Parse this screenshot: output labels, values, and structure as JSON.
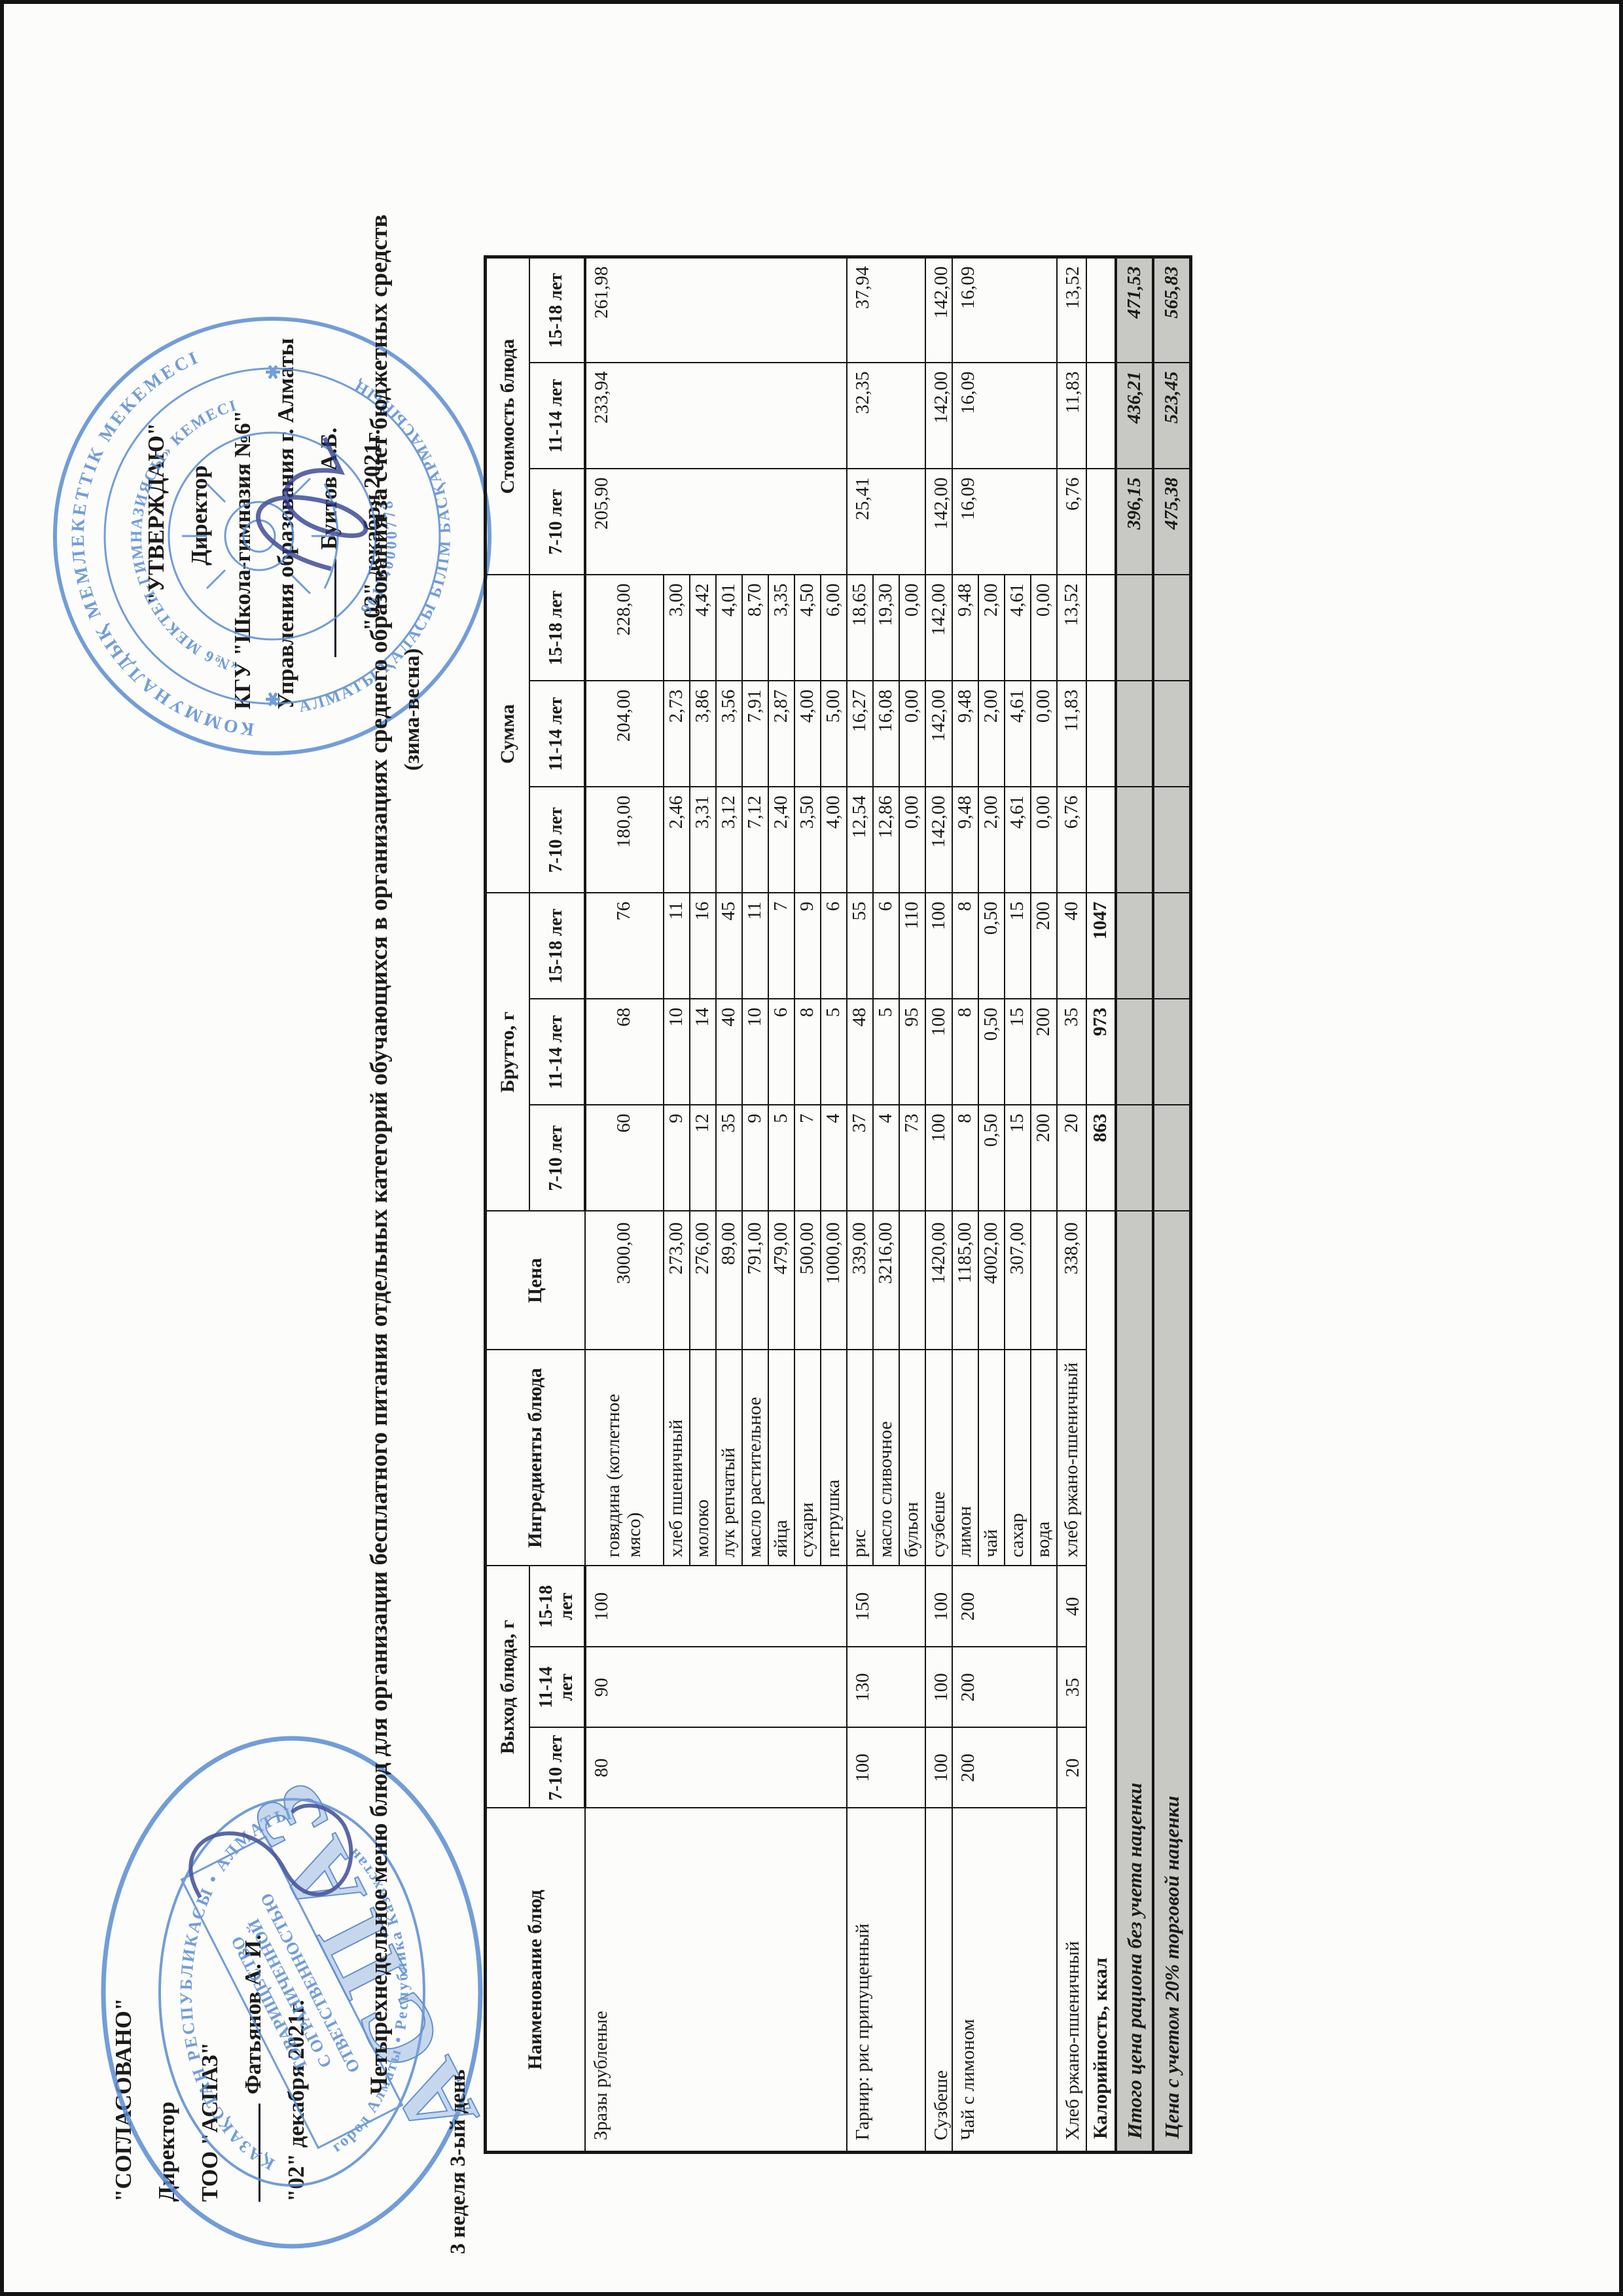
{
  "agreed_block": {
    "title": "\"СОГЛАСОВАНО\"",
    "role": "Директор",
    "org_line1": "ТОО \"АСПАЗ\"",
    "signer": "Фатьянов А. И.",
    "date": "\"02\" декабря 2021г."
  },
  "approved_block": {
    "title": "\"УТВЕРЖДАЮ\"",
    "role": "Директор",
    "org_line1": "КГУ \"Школа-гимназия №6\"",
    "org_line2": "Управления образования г. Алматы",
    "signer": "Буитов А.Б.",
    "date": "\"02\" декабря 2021г."
  },
  "title": "Четырехнедельное меню блюд для организации бесплатного питания отдельных категорий обучающихся в организациях среднего образования за счет бюджетных средств",
  "subtitle": "(зима-весна)",
  "week_label": "3 неделя 3-ый день",
  "table": {
    "headers": {
      "dish": "Наименование блюд",
      "yield": "Выход блюда, г",
      "ingredients": "Ингредиенты блюда",
      "price": "Цена",
      "brutto": "Брутто, г",
      "sum": "Сумма",
      "cost": "Стоимость блюда"
    },
    "age_groups": [
      "7-10 лет",
      "11-14 лет",
      "15-18 лет"
    ],
    "dishes": [
      {
        "name": "Зразы рубленые",
        "yield": [
          "80",
          "90",
          "100"
        ],
        "cost": [
          "205,90",
          "233,94",
          "261,98"
        ],
        "ingredients": [
          {
            "name": "говядина (котлетное мясо)",
            "price": "3000,00",
            "brutto": [
              "60",
              "68",
              "76"
            ],
            "sum": [
              "180,00",
              "204,00",
              "228,00"
            ]
          },
          {
            "name": "хлеб пшеничный",
            "price": "273,00",
            "brutto": [
              "9",
              "10",
              "11"
            ],
            "sum": [
              "2,46",
              "2,73",
              "3,00"
            ]
          },
          {
            "name": "молоко",
            "price": "276,00",
            "brutto": [
              "12",
              "14",
              "16"
            ],
            "sum": [
              "3,31",
              "3,86",
              "4,42"
            ]
          },
          {
            "name": "лук репчатый",
            "price": "89,00",
            "brutto": [
              "35",
              "40",
              "45"
            ],
            "sum": [
              "3,12",
              "3,56",
              "4,01"
            ]
          },
          {
            "name": "масло растительное",
            "price": "791,00",
            "brutto": [
              "9",
              "10",
              "11"
            ],
            "sum": [
              "7,12",
              "7,91",
              "8,70"
            ]
          },
          {
            "name": "яйца",
            "price": "479,00",
            "brutto": [
              "5",
              "6",
              "7"
            ],
            "sum": [
              "2,40",
              "2,87",
              "3,35"
            ]
          },
          {
            "name": "сухари",
            "price": "500,00",
            "brutto": [
              "7",
              "8",
              "9"
            ],
            "sum": [
              "3,50",
              "4,00",
              "4,50"
            ]
          },
          {
            "name": "петрушка",
            "price": "1000,00",
            "brutto": [
              "4",
              "5",
              "6"
            ],
            "sum": [
              "4,00",
              "5,00",
              "6,00"
            ]
          }
        ]
      },
      {
        "name": "Гарнир: рис припущенный",
        "yield": [
          "100",
          "130",
          "150"
        ],
        "cost": [
          "25,41",
          "32,35",
          "37,94"
        ],
        "ingredients": [
          {
            "name": "рис",
            "price": "339,00",
            "brutto": [
              "37",
              "48",
              "55"
            ],
            "sum": [
              "12,54",
              "16,27",
              "18,65"
            ]
          },
          {
            "name": "масло сливочное",
            "price": "3216,00",
            "brutto": [
              "4",
              "5",
              "6"
            ],
            "sum": [
              "12,86",
              "16,08",
              "19,30"
            ]
          },
          {
            "name": "бульон",
            "price": "",
            "brutto": [
              "73",
              "95",
              "110"
            ],
            "sum": [
              "0,00",
              "0,00",
              "0,00"
            ]
          }
        ]
      },
      {
        "name": "Сузбеше",
        "yield": [
          "100",
          "100",
          "100"
        ],
        "cost": [
          "142,00",
          "142,00",
          "142,00"
        ],
        "ingredients": [
          {
            "name": "сузбеше",
            "price": "1420,00",
            "brutto": [
              "100",
              "100",
              "100"
            ],
            "sum": [
              "142,00",
              "142,00",
              "142,00"
            ]
          }
        ]
      },
      {
        "name": "Чай с лимоном",
        "yield": [
          "200",
          "200",
          "200"
        ],
        "cost": [
          "16,09",
          "16,09",
          "16,09"
        ],
        "ingredients": [
          {
            "name": "лимон",
            "price": "1185,00",
            "brutto": [
              "8",
              "8",
              "8"
            ],
            "sum": [
              "9,48",
              "9,48",
              "9,48"
            ]
          },
          {
            "name": "чай",
            "price": "4002,00",
            "brutto": [
              "0,50",
              "0,50",
              "0,50"
            ],
            "sum": [
              "2,00",
              "2,00",
              "2,00"
            ]
          },
          {
            "name": "сахар",
            "price": "307,00",
            "brutto": [
              "15",
              "15",
              "15"
            ],
            "sum": [
              "4,61",
              "4,61",
              "4,61"
            ]
          },
          {
            "name": "вода",
            "price": "",
            "brutto": [
              "200",
              "200",
              "200"
            ],
            "sum": [
              "0,00",
              "0,00",
              "0,00"
            ]
          }
        ]
      },
      {
        "name": "Хлеб ржано-пшеничный",
        "yield": [
          "20",
          "35",
          "40"
        ],
        "cost": [
          "6,76",
          "11,83",
          "13,52"
        ],
        "ingredients": [
          {
            "name": "хлеб ржано-пшеничный",
            "price": "338,00",
            "brutto": [
              "20",
              "35",
              "40"
            ],
            "sum": [
              "6,76",
              "11,83",
              "13,52"
            ]
          }
        ]
      }
    ],
    "calories": {
      "label": "Калорийность, ккал",
      "values": [
        "863",
        "973",
        "1047"
      ]
    },
    "totals": [
      {
        "label": "Итого цена рациона без учета наценки",
        "values": [
          "396,15",
          "436,21",
          "471,53"
        ]
      },
      {
        "label": "Цена с учетом 20% торговой наценки",
        "values": [
          "475,38",
          "523,45",
          "565,83"
        ]
      }
    ]
  },
  "stamps": {
    "left": {
      "ring_text_top": "ҚАЗАҚСТАН РЕСПУБЛИКАСЫ • АЛМАТЫ ҚАЛАСЫ",
      "ring_text_bottom": "город Алматы • Республика Казахстан",
      "box_line1": "ТОВАРИЩЕСТВО",
      "box_line2": "С ОГРАНИЧЕННОЙ",
      "box_line3": "ОТВЕТСТВЕННОСТЬЮ",
      "big_text": "АСПАЗ"
    },
    "right": {
      "ring_text_top": "КОММУНАЛДЫҚ МЕМЛЕКЕТТІК МЕКЕМЕСІ",
      "ring_text_bottom": "АЛМАТЫ ҚАЛАСЫ БІЛІМ БАСҚАРМАСЫНЫҢ",
      "middle_text_top": "«№6 МЕКТЕП-ГИМНАЗИЯСЫ» КЕМЕСІ",
      "number": "961140000778"
    }
  },
  "colors": {
    "stamp_blue": "#5a8dd2",
    "signature_blue": "#2a3a8c",
    "summary_gray": "#c8c9c5",
    "ink": "#1a1a1a"
  }
}
